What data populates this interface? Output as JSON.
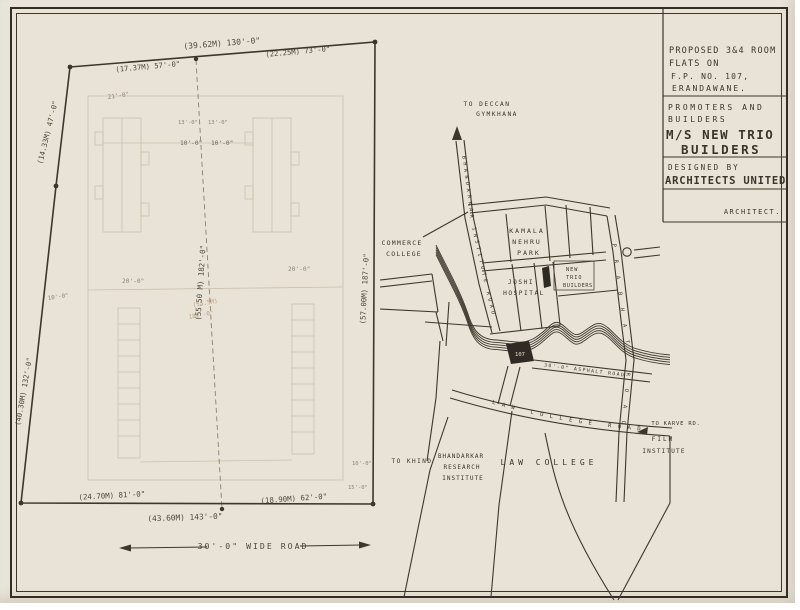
{
  "colors": {
    "paper": "#e8e3d6",
    "ink": "#3a342b",
    "dim_ink": "#4f4739",
    "pencil": "#c6baa5",
    "pencil_text": "#8f8470",
    "sepia_pencil": "#bf9f7e"
  },
  "title_block": {
    "project_line1": "PROPOSED 3&4 ROOM",
    "project_line2": "FLATS ON",
    "project_line3": "F.P. NO. 107,",
    "project_line4": "ERANDAWANE.",
    "promoters_line1": "PROMOTERS AND",
    "promoters_line2": "BUILDERS",
    "builder_name_line1": "M/S NEW TRIO",
    "builder_name_line2": "BUILDERS",
    "designed_by": "DESIGNED BY",
    "designer_name": "ARCHITECTS UNITED",
    "architect_label": "ARCHITECT."
  },
  "site_plan": {
    "dims": {
      "top_total": "(39.62M)  130'-0\"",
      "top_left": "(17.37M) 57'-0\"",
      "top_right": "(22.25M) 73'-0\"",
      "left_upper": "(14.33M) 47'-0\"",
      "left_lower": "(40.30M) 132'-0\"",
      "center_vertical": "(55.50 M) 182'-0\"",
      "center_pencil_m": "(55.5M)",
      "center_pencil_ft": "182'-0\"",
      "right_vertical": "(57.00M) 187'-0\"",
      "bottom_left": "(24.70M) 81'-0\"",
      "bottom_total": "(43.60M)  143'-0\"",
      "bottom_right": "(18.90M) 62'-0\""
    },
    "small_dims": {
      "d21": "21'-0\"",
      "d13a": "13'-0\"",
      "d13b": "13'-0\"",
      "d10a": "10'-0\"",
      "d10b": "10'-0\"",
      "d20a": "20'-0\"",
      "d20b": "20'-0\"",
      "d10c": "10'-0\"",
      "d10d": "10'-0\"",
      "d15a": "15'-0\""
    },
    "road_label": "30'-0\" WIDE ROAD"
  },
  "map": {
    "to_deccan_line1": "TO DECCAN",
    "to_deccan_line2": "GYMKHANA",
    "bhandarkar_road": "BHANDARKAR INSTITUTE ROAD",
    "prabhat_road": "PRABHAT ROAD",
    "kamala_line1": "KAMALA",
    "kamala_line2": "NEHRU",
    "kamala_line3": "PARK",
    "joshi_line1": "JOSHI",
    "joshi_line2": "HOSPITAL",
    "new_trio_line1": "NEW",
    "new_trio_line2": "TRIO",
    "new_trio_line3": "BUILDERS",
    "plot_number": "107",
    "asphalt_road_label": "30'-0\" ASPHALT ROAD",
    "law_college_road_label": "LAW COLLEGE ROAD",
    "to_karve": "TO KARVE RD.",
    "film_line1": "FILM",
    "film_line2": "INSTITUTE",
    "to_khind": "TO KHIND",
    "bri_line1": "BHANDARKAR",
    "bri_line2": "RESEARCH",
    "bri_line3": "INSTITUTE",
    "law_college": "LAW  COLLEGE",
    "commerce_line1": "COMMERCE",
    "commerce_line2": "COLLEGE"
  }
}
